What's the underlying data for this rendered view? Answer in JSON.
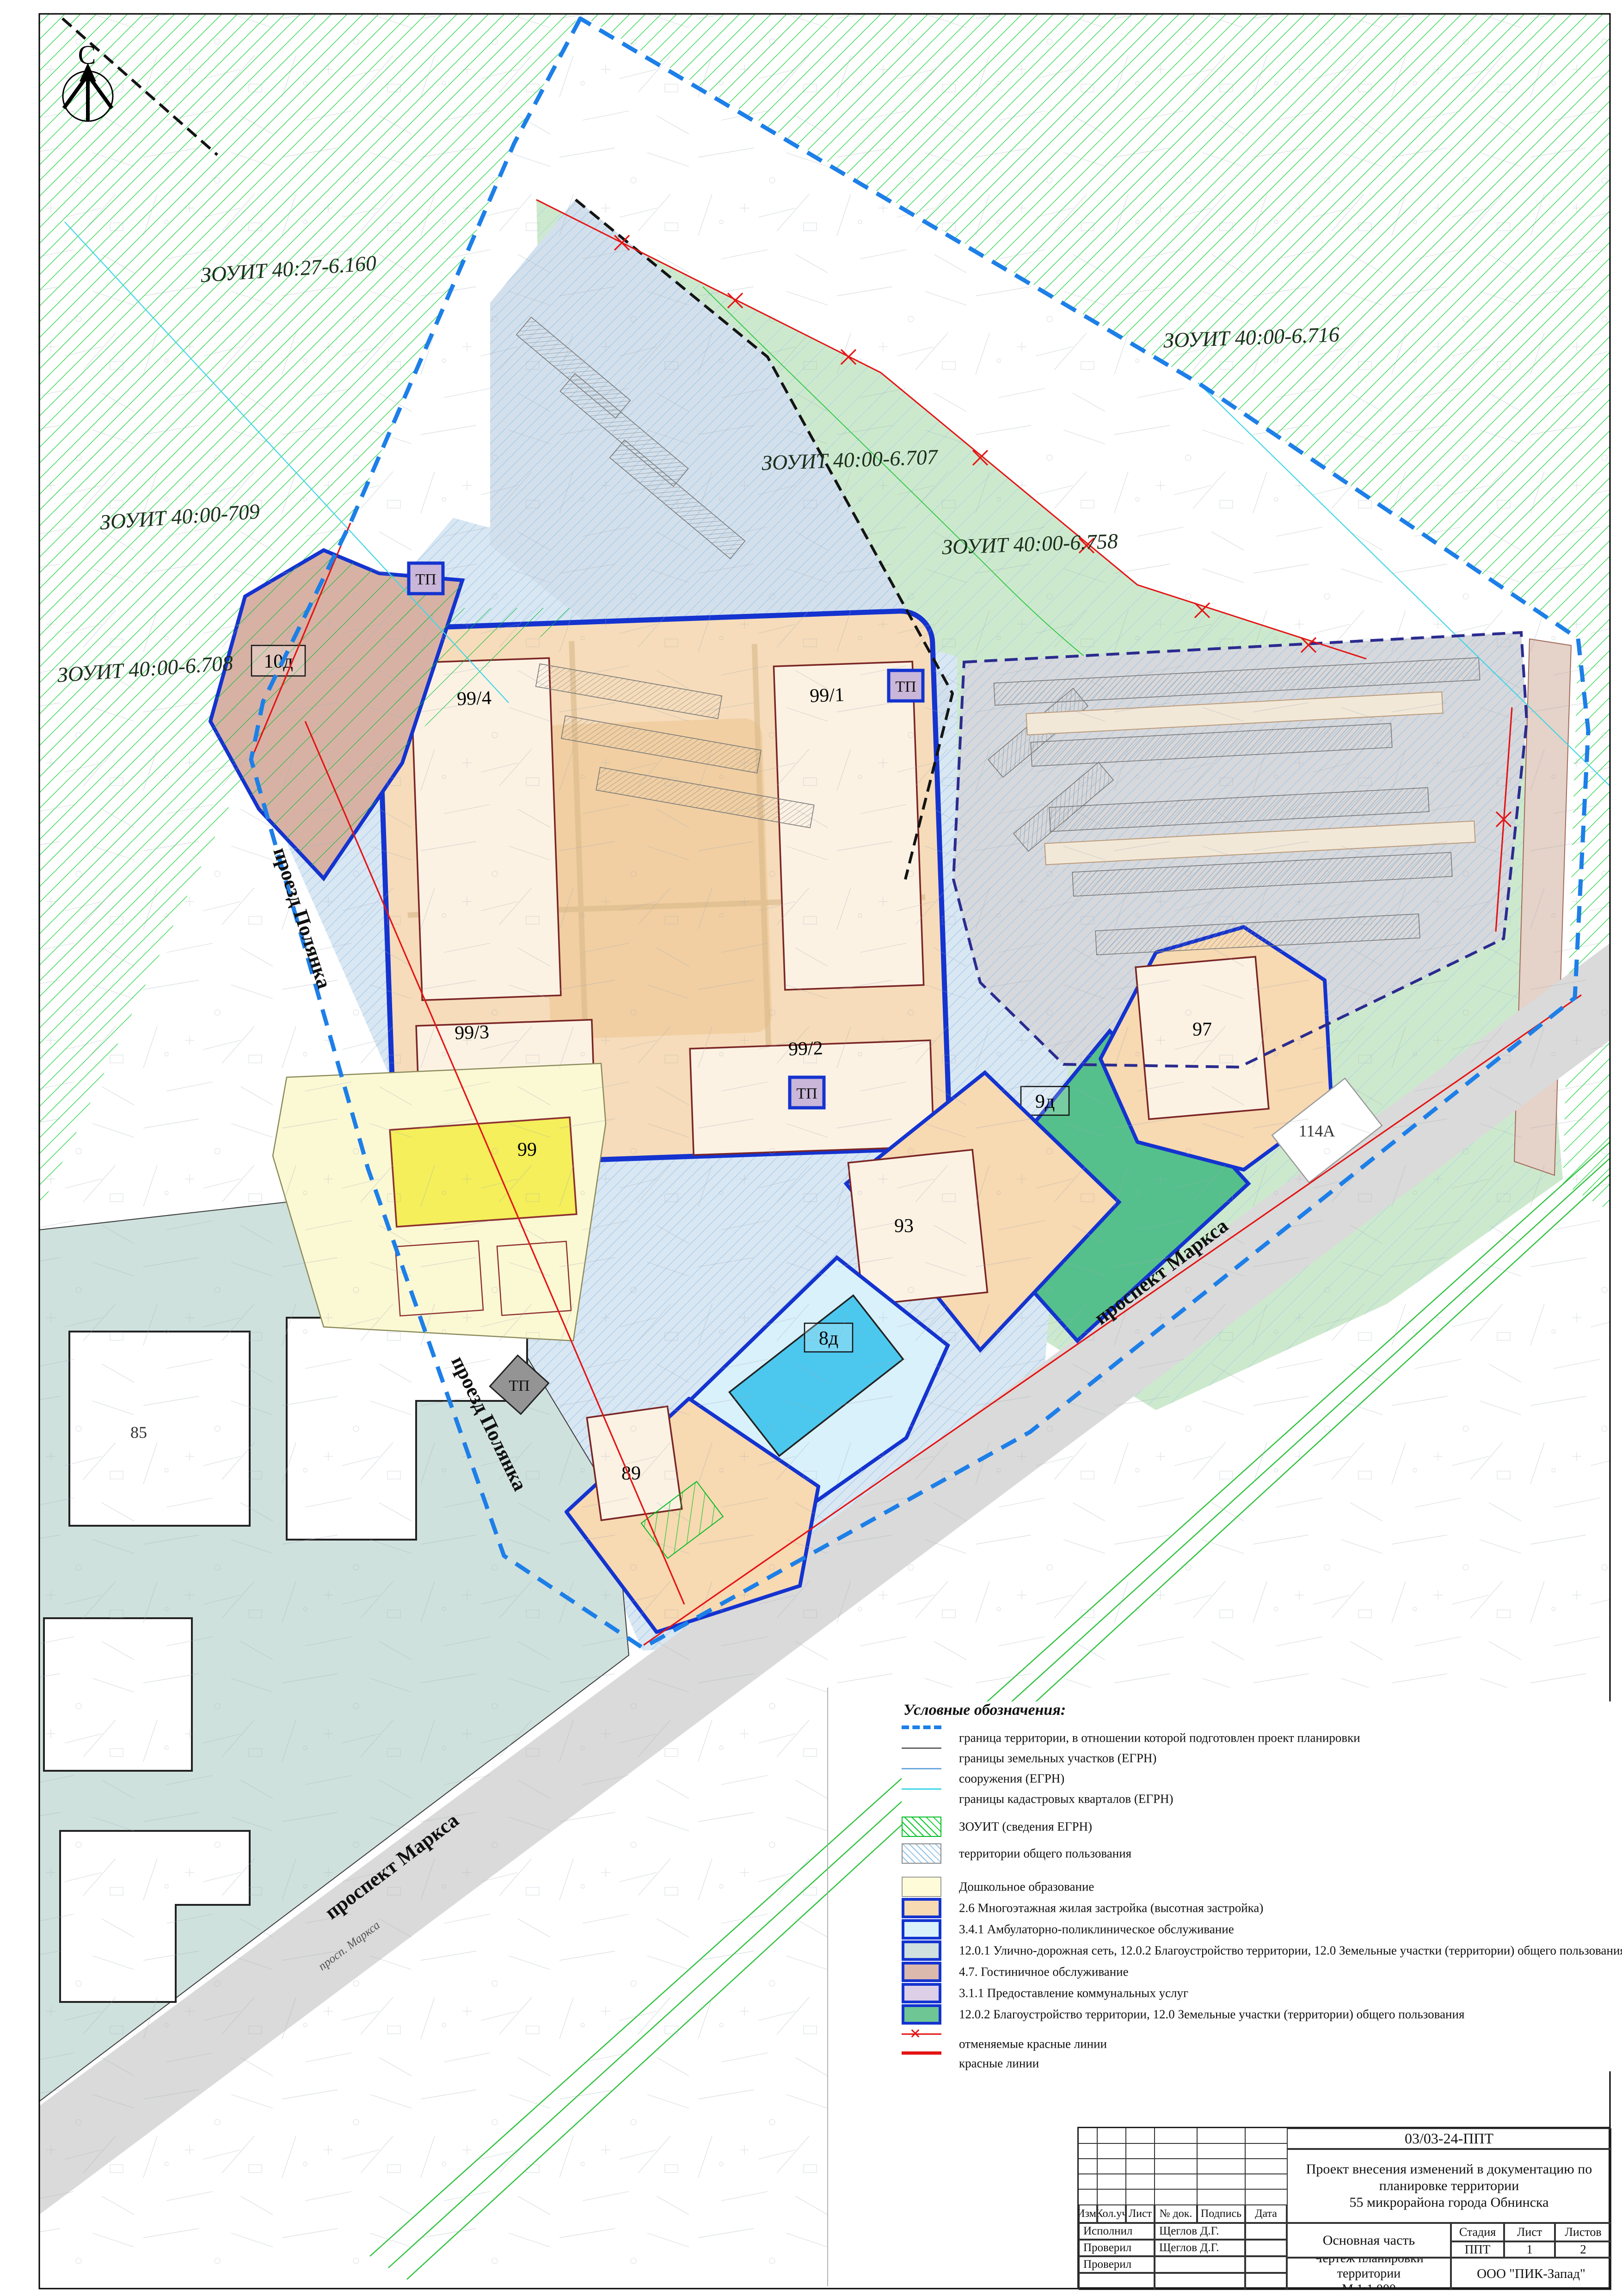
{
  "map": {
    "north": "С",
    "tp_label": "ТП",
    "zouit": [
      "ЗОУИТ 40:27-6.160",
      "ЗОУИТ 40:00-6.716",
      "ЗОУИТ 40:00-6.707",
      "ЗОУИТ 40:00-6.758",
      "ЗОУИТ 40:00-709",
      "ЗОУИТ 40:00-6.708"
    ],
    "labels": {
      "q994": "99/4",
      "q991": "99/1",
      "q993": "99/3",
      "q992": "99/2",
      "k99": "99",
      "k93": "93",
      "k97": "97",
      "k89": "89",
      "k8d": "8д",
      "k9d": "9д",
      "k10d": "10д",
      "b114a": "114А",
      "b85": "85"
    },
    "streets": {
      "polyanka": "проезд Полянка",
      "marksa": "проспект Маркса",
      "marksa_small": "просп. Маркса"
    },
    "colors": {
      "boundary_blue": "#1d7fe8",
      "red_line": "#e41414",
      "zouit_hatch": "#00cc22",
      "public_hatch": "#8ec2e8",
      "quarter_fill": "#f6dcba",
      "parcel_border": "#1433cf"
    }
  },
  "legend": {
    "title": "Условные обозначения:",
    "lines": [
      "граница территории, в отношении которой подготовлен проект планировки",
      "границы земельных участков (ЕГРН)",
      "сооружения (ЕГРН)",
      "границы кадастровых кварталов (ЕГРН)"
    ],
    "hatches": [
      "ЗОУИТ (сведения ЕГРН)",
      "территории общего пользования"
    ],
    "zones": [
      "Дошкольное образование",
      "2.6 Многоэтажная жилая застройка (высотная застройка)",
      "3.4.1 Амбулаторно-поликлиническое обслуживание",
      "12.0.1 Улично-дорожная сеть, 12.0.2 Благоустройство территории, 12.0 Земельные участки (территории) общего пользования",
      "4.7. Гостиничное обслуживание",
      "3.1.1 Предоставление коммунальных услуг",
      "12.0.2 Благоустройство территории, 12.0 Земельные участки (территории) общего пользования"
    ],
    "red": [
      "отменяемые красные линии",
      "красные линии"
    ]
  },
  "title_block": {
    "doc_code": "03/03-24-ППТ",
    "project_line1": "Проект внесения изменений в документацию по планировке  территории",
    "project_line2": "55 микрорайона города Обнинска",
    "cols": [
      "Изм.",
      "Кол.уч",
      "Лист",
      "№ док.",
      "Подпись",
      "Дата"
    ],
    "row_labels": [
      "Исполнил",
      "Проверил",
      "Проверил"
    ],
    "row_names": [
      "Щеглов Д.Г.",
      "Щеглов Д.Г.",
      ""
    ],
    "part": "Основная часть",
    "stage_label": "Стадия",
    "sheet_label": "Лист",
    "sheets_label": "Листов",
    "stage": "ППТ",
    "sheet": "1",
    "sheets": "2",
    "drawing": "Чертеж планировки территории",
    "scale": "М 1:1 000",
    "company": "ООО \"ПИК-Запад\""
  }
}
